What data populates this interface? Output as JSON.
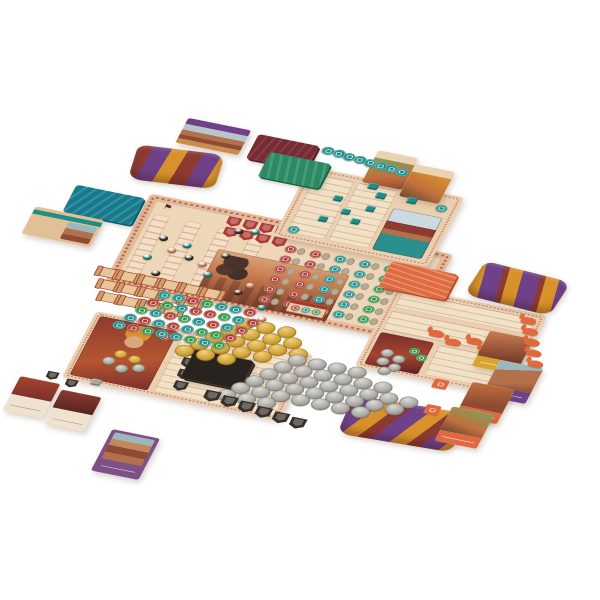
{
  "scene": {
    "title": "Board game components flat-lay product photo",
    "background": "#ffffff"
  },
  "palette": {
    "board": "#e3ba97",
    "panel": "#f0d9bc",
    "frame_red": "#ad4136",
    "teal": "#1f8e89",
    "red": "#ac3a33",
    "green": "#2f9447",
    "gold": "#d2a338",
    "silver": "#aaa9a3",
    "salmon": "#e78b68",
    "black": "#38302b",
    "maroon": "#8d3a31",
    "purple": "#6f4189",
    "bag_gold": "#d8922b",
    "orange": "#e0693f",
    "teal_deck": "#147a8c",
    "dark_deck": "#292320",
    "green_deck": "#2a8a63",
    "maroon_deck": "#772c33",
    "gray_oval": "#b6ab97"
  },
  "icons": {
    "flag": "⚑",
    "x_mark": "✕"
  },
  "counts": {
    "gold_coins": 19,
    "silver_coins": 36,
    "scroll_tokens": 15,
    "resource_discs": {
      "teal": 16,
      "red": 13,
      "green": 10
    },
    "teal_discs": 10,
    "teal_cubes": 8,
    "black_shields": 12,
    "red_shields": 8,
    "camel_tokens": 10,
    "beads": {
      "black": 8,
      "teal": 7,
      "salmon": 6
    }
  },
  "market_grid": {
    "rows": 6,
    "cols": 6,
    "column_colors": [
      "red",
      "red",
      "teal",
      "teal",
      "green",
      "green"
    ]
  },
  "generators": [
    {
      "target": "#market-grid",
      "kind": "pairs",
      "rows": 6,
      "cols": 6,
      "dx": 26,
      "dy": 17,
      "colors": [
        "red",
        "red",
        "teal",
        "teal",
        "green",
        "green"
      ]
    },
    {
      "target": "#red-shield-grid",
      "kind": "rows",
      "tok": "shield",
      "color": "red",
      "size": 14,
      "rows": [
        4,
        4
      ],
      "dx": 17,
      "dy": 17,
      "shift": 2
    },
    {
      "target": "#board-beads",
      "kind": "points",
      "tok": "bead",
      "size": 9,
      "groups": [
        {
          "color": "black",
          "pts": [
            [
              20,
              36
            ],
            [
              54,
              58
            ],
            [
              88,
              44
            ],
            [
              30,
              92
            ],
            [
              68,
              104
            ],
            [
              118,
              96
            ],
            [
              88,
              2
            ],
            [
              140,
              124
            ]
          ]
        },
        {
          "color": "teal",
          "pts": [
            [
              46,
              40
            ],
            [
              14,
              70
            ],
            [
              80,
              78
            ],
            [
              100,
              108
            ],
            [
              58,
              128
            ],
            [
              104,
              -2
            ],
            [
              148,
              112
            ]
          ]
        },
        {
          "color": "salmon",
          "pts": [
            [
              34,
              52
            ],
            [
              70,
              64
            ],
            [
              16,
              108
            ],
            [
              94,
              122
            ],
            [
              126,
              82
            ],
            [
              154,
              130
            ]
          ]
        }
      ]
    },
    {
      "target": "#teal-disc-row",
      "kind": "row",
      "tok": "disc",
      "color": "teal",
      "size": 13,
      "count": 8,
      "dx": 11.5,
      "dy": 1.4
    },
    {
      "target": "#teal-board-discs",
      "kind": "points",
      "tok": "disc",
      "size": 12,
      "groups": [
        {
          "color": "teal",
          "pts": [
            [
              4,
              90
            ],
            [
              134,
              12
            ]
          ]
        }
      ]
    },
    {
      "target": "#teal-cubes",
      "kind": "points",
      "tok": "cube",
      "size": 9,
      "groups": [
        {
          "color": "teal",
          "pts": [
            [
              30,
              28
            ],
            [
              44,
              46
            ],
            [
              26,
              64
            ],
            [
              58,
              58
            ],
            [
              66,
              34
            ]
          ]
        }
      ]
    },
    {
      "target": "#card-cubes",
      "kind": "points",
      "tok": "cube",
      "size": 10,
      "groups": [
        {
          "color": "teal",
          "pts": [
            [
              0,
              0
            ],
            [
              12,
              12
            ],
            [
              44,
              10
            ]
          ]
        }
      ]
    },
    {
      "target": "#gold-coins",
      "kind": "rows",
      "tok": "coin",
      "color": "gold",
      "size": 19,
      "rows": [
        3,
        4,
        5,
        4,
        3
      ],
      "dx": 22,
      "dy": 15,
      "shift": -11
    },
    {
      "target": "#silver-coins",
      "kind": "rows",
      "tok": "coin-s",
      "color": "silver",
      "size": 19,
      "rows": [
        4,
        6,
        8,
        8,
        7,
        3
      ],
      "dx": 21,
      "dy": 15,
      "shift": -10
    },
    {
      "target": "#resource-cluster",
      "kind": "rows-multi",
      "tok": "disc",
      "size": 13,
      "rows": [
        7,
        8,
        8,
        8,
        8
      ],
      "dx": 15,
      "dy": 15,
      "shift": -7,
      "colors": {
        "teal": 16,
        "red": 13,
        "green": 10
      }
    },
    {
      "target": "#scroll-cluster",
      "kind": "rows",
      "tok": "scroll",
      "rows": [
        6,
        5,
        4
      ],
      "dx": 22,
      "dy": 19,
      "shift": 7
    },
    {
      "target": "#black-shield-row",
      "kind": "row",
      "tok": "shield",
      "color": "black",
      "size": 16,
      "count": 6,
      "dx": 19,
      "dy": 3
    },
    {
      "target": "#red-board-shields",
      "kind": "row",
      "tok": "shield",
      "color": "black",
      "size": 14,
      "count": 4,
      "dx": 2,
      "dy": 19
    },
    {
      "target": "#camel-column",
      "kind": "row",
      "tok": "camel",
      "color": "orange",
      "count": 5,
      "dx": 7,
      "dy": 16
    },
    {
      "target": "#orange-camels",
      "kind": "points",
      "tok": "camel",
      "groups": [
        {
          "color": "orange",
          "pts": [
            [
              44,
              52
            ],
            [
              64,
              60
            ],
            [
              84,
              52
            ],
            [
              100,
              64
            ],
            [
              116,
              56
            ]
          ]
        }
      ]
    },
    {
      "target": "#orange-art-coins",
      "kind": "points",
      "groups": [
        {
          "tok": "coin-s",
          "color": "silver",
          "size": 13,
          "pts": [
            [
              10,
              24
            ],
            [
              24,
              30
            ],
            [
              10,
              38
            ],
            [
              24,
              44
            ],
            [
              16,
              52
            ]
          ]
        },
        {
          "tok": "disc",
          "color": "green",
          "size": 11,
          "pts": [
            [
              36,
              14
            ],
            [
              46,
              22
            ]
          ]
        }
      ]
    },
    {
      "target": "#red-art-coins",
      "kind": "points",
      "groups": [
        {
          "tok": "coin-s",
          "color": "silver",
          "size": 13,
          "pts": [
            [
              24,
              60
            ],
            [
              40,
              68
            ],
            [
              56,
              62
            ]
          ]
        },
        {
          "tok": "coin",
          "color": "gold",
          "size": 13,
          "pts": [
            [
              32,
              46
            ],
            [
              48,
              50
            ]
          ]
        },
        {
          "tok": "disc",
          "color": "red",
          "size": 12,
          "pts": [
            [
              66,
              6
            ]
          ]
        }
      ]
    },
    {
      "target": "#mini-shields",
      "kind": "points",
      "groups": [
        {
          "tok": "shield",
          "color": "black",
          "size": 12,
          "pts": [
            [
              0,
              0
            ],
            [
              22,
              6
            ]
          ]
        },
        {
          "tok": "cube",
          "color": "silver",
          "size": 10,
          "pts": [
            [
              46,
              -2
            ]
          ]
        }
      ]
    },
    {
      "target": "#stall-discs",
      "kind": "points",
      "groups": [
        {
          "tok": "disc",
          "color": "red",
          "size": 9,
          "pts": [
            [
              3,
              7
            ]
          ]
        },
        {
          "tok": "disc",
          "color": "teal",
          "size": 9,
          "pts": [
            [
              14,
              7
            ]
          ]
        },
        {
          "tok": "disc",
          "color": "green",
          "size": 9,
          "pts": [
            [
              25,
              7
            ]
          ]
        }
      ]
    }
  ]
}
